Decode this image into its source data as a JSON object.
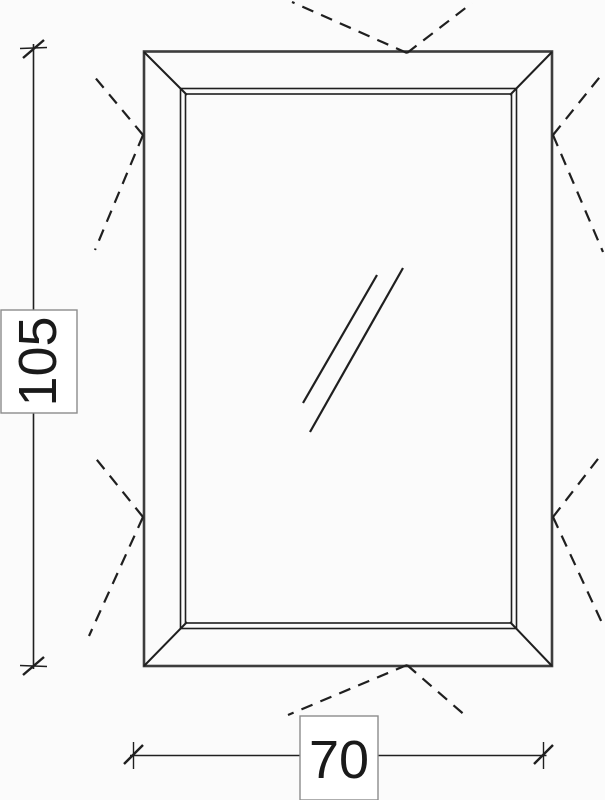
{
  "drawing": {
    "type": "window-elevation-technical-drawing",
    "dimension_height": {
      "value": "105"
    },
    "dimension_width": {
      "value": "70"
    }
  },
  "icons": {
    "glass_reflection": "double-diagonal-lines",
    "opening_direction": "dashed-v-marks"
  },
  "colors": {
    "background": "#fbfbfb",
    "line": "#1f1f1f",
    "frame-outline": "#3d3d3d",
    "box-border": "#8c8c8c",
    "box-fill": "#ffffff",
    "text": "#1a1a1a"
  }
}
